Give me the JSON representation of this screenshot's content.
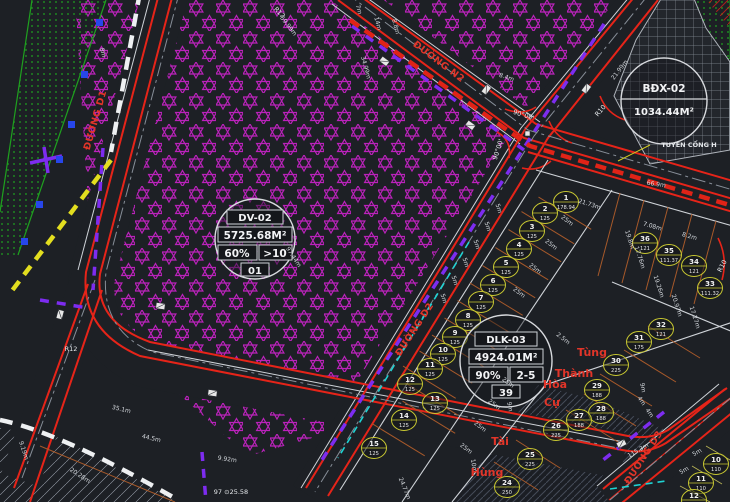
{
  "app": {
    "title": "Urban land-use CAD plan view"
  },
  "parcels": [
    {
      "id": "DV-02",
      "area": "5725.68M²",
      "density": "60%",
      "floors": ">10",
      "code": "01",
      "type": "full",
      "cx": 255,
      "cy": 239,
      "r": 40
    },
    {
      "id": "DLK-03",
      "area": "4924.01M²",
      "density": "90%",
      "floors": "2-5",
      "code": "39",
      "type": "full",
      "cx": 506,
      "cy": 361,
      "r": 46
    },
    {
      "id": "BĐX-02",
      "area": "1034.44M²",
      "type": "simple",
      "cx": 664,
      "cy": 101,
      "r": 43
    }
  ],
  "road_labels": [
    {
      "t": "ĐƯỜNG D1",
      "x": 98,
      "y": 121,
      "r": -74
    },
    {
      "t": "ĐƯỜNG N2",
      "x": 437,
      "y": 64,
      "r": 37
    },
    {
      "t": "ĐƯỜNG D2",
      "x": 417,
      "y": 331,
      "r": -57
    },
    {
      "t": "ĐƯỜNG D3",
      "x": 646,
      "y": 459,
      "r": -57
    }
  ],
  "owner_labels": [
    {
      "t": "Tùng",
      "x": 592,
      "y": 356,
      "r": 0
    },
    {
      "t": "Thành",
      "x": 574,
      "y": 377,
      "r": 0
    },
    {
      "t": "Hòa",
      "x": 555,
      "y": 388,
      "r": 0
    },
    {
      "t": "Cự",
      "x": 552,
      "y": 406,
      "r": 0
    },
    {
      "t": "Tài",
      "x": 500,
      "y": 445,
      "r": 0
    },
    {
      "t": "Hùng",
      "x": 487,
      "y": 476,
      "r": 0
    }
  ],
  "note_labels": [
    {
      "t": "90°00'",
      "x": 523,
      "y": 117,
      "r": 18
    },
    {
      "t": "90°00'",
      "x": 500,
      "y": 150,
      "r": -72
    },
    {
      "t": "R12",
      "x": 278,
      "y": 14,
      "r": 45
    },
    {
      "t": "R12",
      "x": 71,
      "y": 351,
      "r": 0
    },
    {
      "t": "R10",
      "x": 602,
      "y": 112,
      "r": -50,
      "c": "#e63c2e"
    },
    {
      "t": "R10",
      "x": 724,
      "y": 267,
      "r": -62,
      "c": "#e63c2e"
    },
    {
      "t": "TUYẾN CỐNG H",
      "x": 689,
      "y": 147,
      "r": 0,
      "b": true
    },
    {
      "t": "97 ⊙25.58",
      "x": 231,
      "y": 494,
      "r": 0
    }
  ],
  "dimension_labels": [
    {
      "t": "59.99m",
      "x": 287,
      "y": 27,
      "r": 52
    },
    {
      "t": "97.44m",
      "x": 292,
      "y": 258,
      "r": 57
    },
    {
      "t": "8m",
      "x": 101,
      "y": 53,
      "r": 75
    },
    {
      "t": "21.73m",
      "x": 589,
      "y": 206,
      "r": 18
    },
    {
      "t": "21.99m",
      "x": 621,
      "y": 71,
      "r": -52
    },
    {
      "t": "7m",
      "x": 357,
      "y": 10,
      "r": 75
    },
    {
      "t": "14m",
      "x": 376,
      "y": 24,
      "r": 75
    },
    {
      "t": "8.8m",
      "x": 394,
      "y": 27,
      "r": 75
    },
    {
      "t": "34.99m",
      "x": 364,
      "y": 68,
      "r": 75
    },
    {
      "t": "8.4m",
      "x": 506,
      "y": 79,
      "r": 18
    },
    {
      "t": "66.9m",
      "x": 656,
      "y": 186,
      "r": 8
    },
    {
      "t": "7.08m",
      "x": 652,
      "y": 228,
      "r": 16
    },
    {
      "t": "8.2m",
      "x": 689,
      "y": 238,
      "r": 16
    },
    {
      "t": "19.8m",
      "x": 628,
      "y": 240,
      "r": 72
    },
    {
      "t": "17.76m",
      "x": 638,
      "y": 258,
      "r": 72
    },
    {
      "t": "19.26m",
      "x": 657,
      "y": 287,
      "r": 72
    },
    {
      "t": "20.97m",
      "x": 675,
      "y": 306,
      "r": 72
    },
    {
      "t": "17.27m",
      "x": 693,
      "y": 318,
      "r": 72
    },
    {
      "t": "25m",
      "x": 566,
      "y": 222,
      "r": 38
    },
    {
      "t": "25m",
      "x": 550,
      "y": 246,
      "r": 38
    },
    {
      "t": "25m",
      "x": 534,
      "y": 270,
      "r": 38
    },
    {
      "t": "25m",
      "x": 518,
      "y": 294,
      "r": 38
    },
    {
      "t": "25m",
      "x": 507,
      "y": 384,
      "r": 38
    },
    {
      "t": "25m",
      "x": 493,
      "y": 406,
      "r": 38
    },
    {
      "t": "25m",
      "x": 479,
      "y": 428,
      "r": 38
    },
    {
      "t": "25m",
      "x": 465,
      "y": 450,
      "r": 38
    },
    {
      "t": "5m",
      "x": 497,
      "y": 209,
      "r": 72
    },
    {
      "t": "5m",
      "x": 486,
      "y": 227,
      "r": 72
    },
    {
      "t": "5m",
      "x": 475,
      "y": 245,
      "r": 72
    },
    {
      "t": "5m",
      "x": 464,
      "y": 263,
      "r": 72
    },
    {
      "t": "5m",
      "x": 453,
      "y": 281,
      "r": 72
    },
    {
      "t": "5m",
      "x": 442,
      "y": 299,
      "r": 72
    },
    {
      "t": "2.5m",
      "x": 562,
      "y": 340,
      "r": 38
    },
    {
      "t": "24.77m",
      "x": 403,
      "y": 489,
      "r": 68
    },
    {
      "t": "9m",
      "x": 508,
      "y": 407,
      "r": 80
    },
    {
      "t": "10m",
      "x": 472,
      "y": 466,
      "r": 80
    },
    {
      "t": "9m",
      "x": 641,
      "y": 388,
      "r": 80
    },
    {
      "t": "4m",
      "x": 640,
      "y": 402,
      "r": 55
    },
    {
      "t": "4m",
      "x": 648,
      "y": 414,
      "r": 55
    },
    {
      "t": "35.1m",
      "x": 121,
      "y": 411,
      "r": 13
    },
    {
      "t": "44.5m",
      "x": 151,
      "y": 440,
      "r": 13
    },
    {
      "t": "9.19m",
      "x": 22,
      "y": 451,
      "r": 72
    },
    {
      "t": "20.28m",
      "x": 79,
      "y": 477,
      "r": 33
    },
    {
      "t": "9.92m",
      "x": 227,
      "y": 461,
      "r": 8
    },
    {
      "t": "115.3m",
      "x": 639,
      "y": 452,
      "r": -30
    },
    {
      "t": "5m",
      "x": 698,
      "y": 454,
      "r": -30
    },
    {
      "t": "5m",
      "x": 685,
      "y": 472,
      "r": -30
    }
  ],
  "lots": [
    {
      "n": "1",
      "a": "178.94",
      "x": 566,
      "y": 202,
      "g": "c1"
    },
    {
      "n": "2",
      "a": "125",
      "x": 545,
      "y": 213,
      "g": "c1"
    },
    {
      "n": "3",
      "a": "125",
      "x": 532,
      "y": 231,
      "g": "c1"
    },
    {
      "n": "4",
      "a": "125",
      "x": 519,
      "y": 249,
      "g": "c1"
    },
    {
      "n": "5",
      "a": "125",
      "x": 506,
      "y": 267,
      "g": "c1"
    },
    {
      "n": "6",
      "a": "125",
      "x": 493,
      "y": 285,
      "g": "c1"
    },
    {
      "n": "7",
      "a": "125",
      "x": 481,
      "y": 302,
      "g": "c1"
    },
    {
      "n": "8",
      "a": "125",
      "x": 468,
      "y": 320,
      "g": "c1"
    },
    {
      "n": "9",
      "a": "125",
      "x": 455,
      "y": 337,
      "g": "c1"
    },
    {
      "n": "10",
      "a": "125",
      "x": 443,
      "y": 354,
      "g": "c1"
    },
    {
      "n": "11",
      "a": "125",
      "x": 430,
      "y": 369,
      "g": "c1"
    },
    {
      "n": "12",
      "a": "125",
      "x": 410,
      "y": 384,
      "g": "c1"
    },
    {
      "n": "13",
      "a": "125",
      "x": 435,
      "y": 403,
      "g": "c1"
    },
    {
      "n": "14",
      "a": "125",
      "x": 404,
      "y": 420,
      "g": "c1"
    },
    {
      "n": "15",
      "a": "125",
      "x": 374,
      "y": 448,
      "g": "c1"
    },
    {
      "n": "36",
      "a": "121",
      "x": 645,
      "y": 243,
      "g": "r"
    },
    {
      "n": "35",
      "a": "111.37",
      "x": 669,
      "y": 255,
      "g": "r"
    },
    {
      "n": "34",
      "a": "121",
      "x": 694,
      "y": 266,
      "g": "r"
    },
    {
      "n": "33",
      "a": "111.32",
      "x": 710,
      "y": 288,
      "g": "r"
    },
    {
      "n": "32",
      "a": "121",
      "x": 661,
      "y": 329,
      "g": "r"
    },
    {
      "n": "31",
      "a": "175",
      "x": 639,
      "y": 342,
      "g": "r"
    },
    {
      "n": "30",
      "a": "225",
      "x": 616,
      "y": 365,
      "g": "r"
    },
    {
      "n": "29",
      "a": "188",
      "x": 597,
      "y": 390,
      "g": "r"
    },
    {
      "n": "28",
      "a": "188",
      "x": 601,
      "y": 413,
      "g": "r"
    },
    {
      "n": "27",
      "a": "188",
      "x": 579,
      "y": 420,
      "g": "r"
    },
    {
      "n": "26",
      "a": "225",
      "x": 556,
      "y": 430,
      "g": "r"
    },
    {
      "n": "25",
      "a": "225",
      "x": 530,
      "y": 459,
      "g": "r"
    },
    {
      "n": "24",
      "a": "250",
      "x": 507,
      "y": 487,
      "g": "r"
    },
    {
      "n": "10",
      "a": "110",
      "x": 716,
      "y": 464,
      "g": "br"
    },
    {
      "n": "11",
      "a": "110",
      "x": 701,
      "y": 483,
      "g": "br"
    },
    {
      "n": "12",
      "a": "110",
      "x": 694,
      "y": 500,
      "g": "br"
    }
  ],
  "colors": {
    "background": "#1d2025",
    "road_red": "#e62419",
    "star_hatch": "#c322c3",
    "utility_purple": "#7d2cf0",
    "boundary_yellow": "#e3de1f",
    "cyan_line": "#1fd3d3",
    "green_strip": "#1fa11f",
    "lot_circle": "#c8c832",
    "owner_red": "#e23529",
    "dim_white": "#d4d8dd",
    "lot_divider_orange": "#a7592a"
  }
}
